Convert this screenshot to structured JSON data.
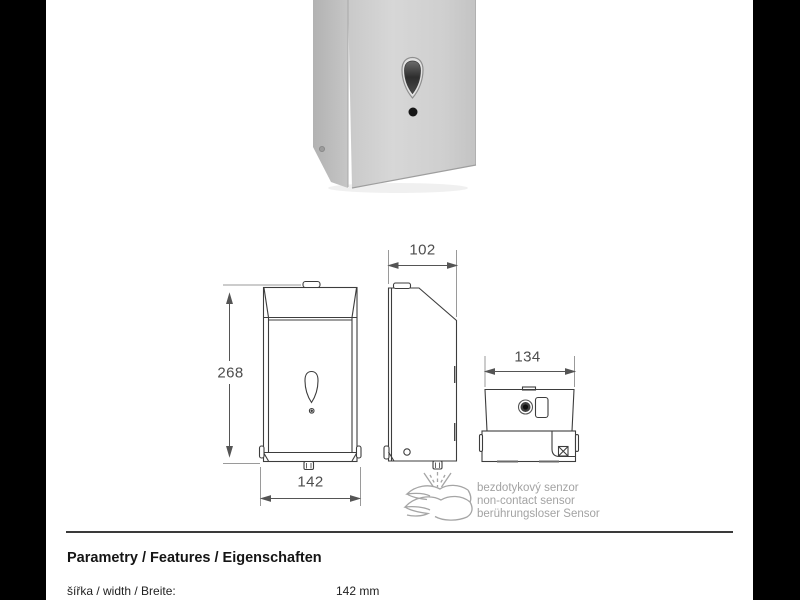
{
  "page": {
    "bg_color": "#000000",
    "paper_color": "#ffffff",
    "line_color": "#3d3d3d",
    "dim_text_color": "#4d4d4d",
    "muted_text_color": "#a3a3a3"
  },
  "photo": {
    "name": "stainless-steel-sensor-dispenser"
  },
  "drawing": {
    "dim_height": "268",
    "dim_width": "142",
    "dim_depth": "102",
    "dim_bottom_width": "134",
    "sensor_caption": [
      "bezdotykový senzor",
      "non-contact sensor",
      "berührungsloser Sensor"
    ]
  },
  "specs": {
    "heading": "Parametry / Features / Eigenschaften",
    "rows": [
      {
        "label": "šířka / width / Breite:",
        "value": "142 mm"
      },
      {
        "label": "výška / height / Höhe:",
        "value": ""
      }
    ]
  }
}
